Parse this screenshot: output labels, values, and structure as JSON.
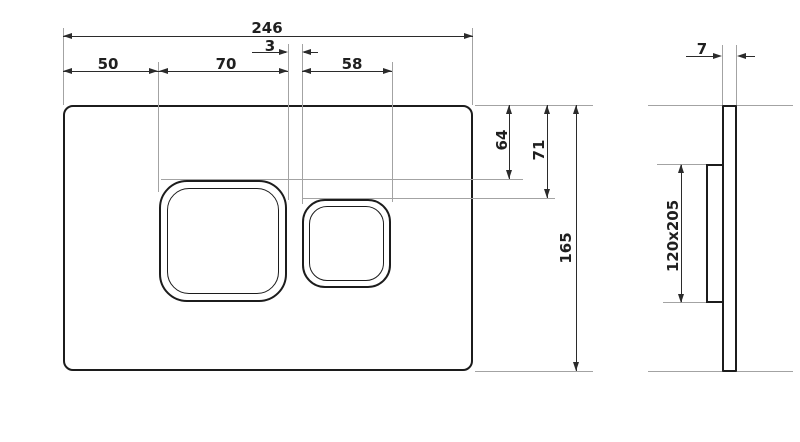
{
  "drawing": {
    "type": "technical-drawing",
    "subject": "flush plate with two buttons - dimensioned front and side views",
    "background": "#ffffff",
    "colors": {
      "outline": "#1c1c1c",
      "dimension_lines": "#2b2b2b",
      "extension_lines": "#a3a3a3",
      "text": "#1f1f1f"
    },
    "front_view": {
      "dimensions": {
        "overall_width": "246",
        "button_gap": "3",
        "left_edge_to_large_button": "50",
        "large_button_width": "70",
        "small_button_width": "58",
        "top_to_large_button": "64",
        "top_to_small_button": "71",
        "overall_height": "165"
      }
    },
    "side_view": {
      "dimensions": {
        "plate_thickness": "7",
        "mounting_frame_size": "120x205"
      }
    }
  }
}
